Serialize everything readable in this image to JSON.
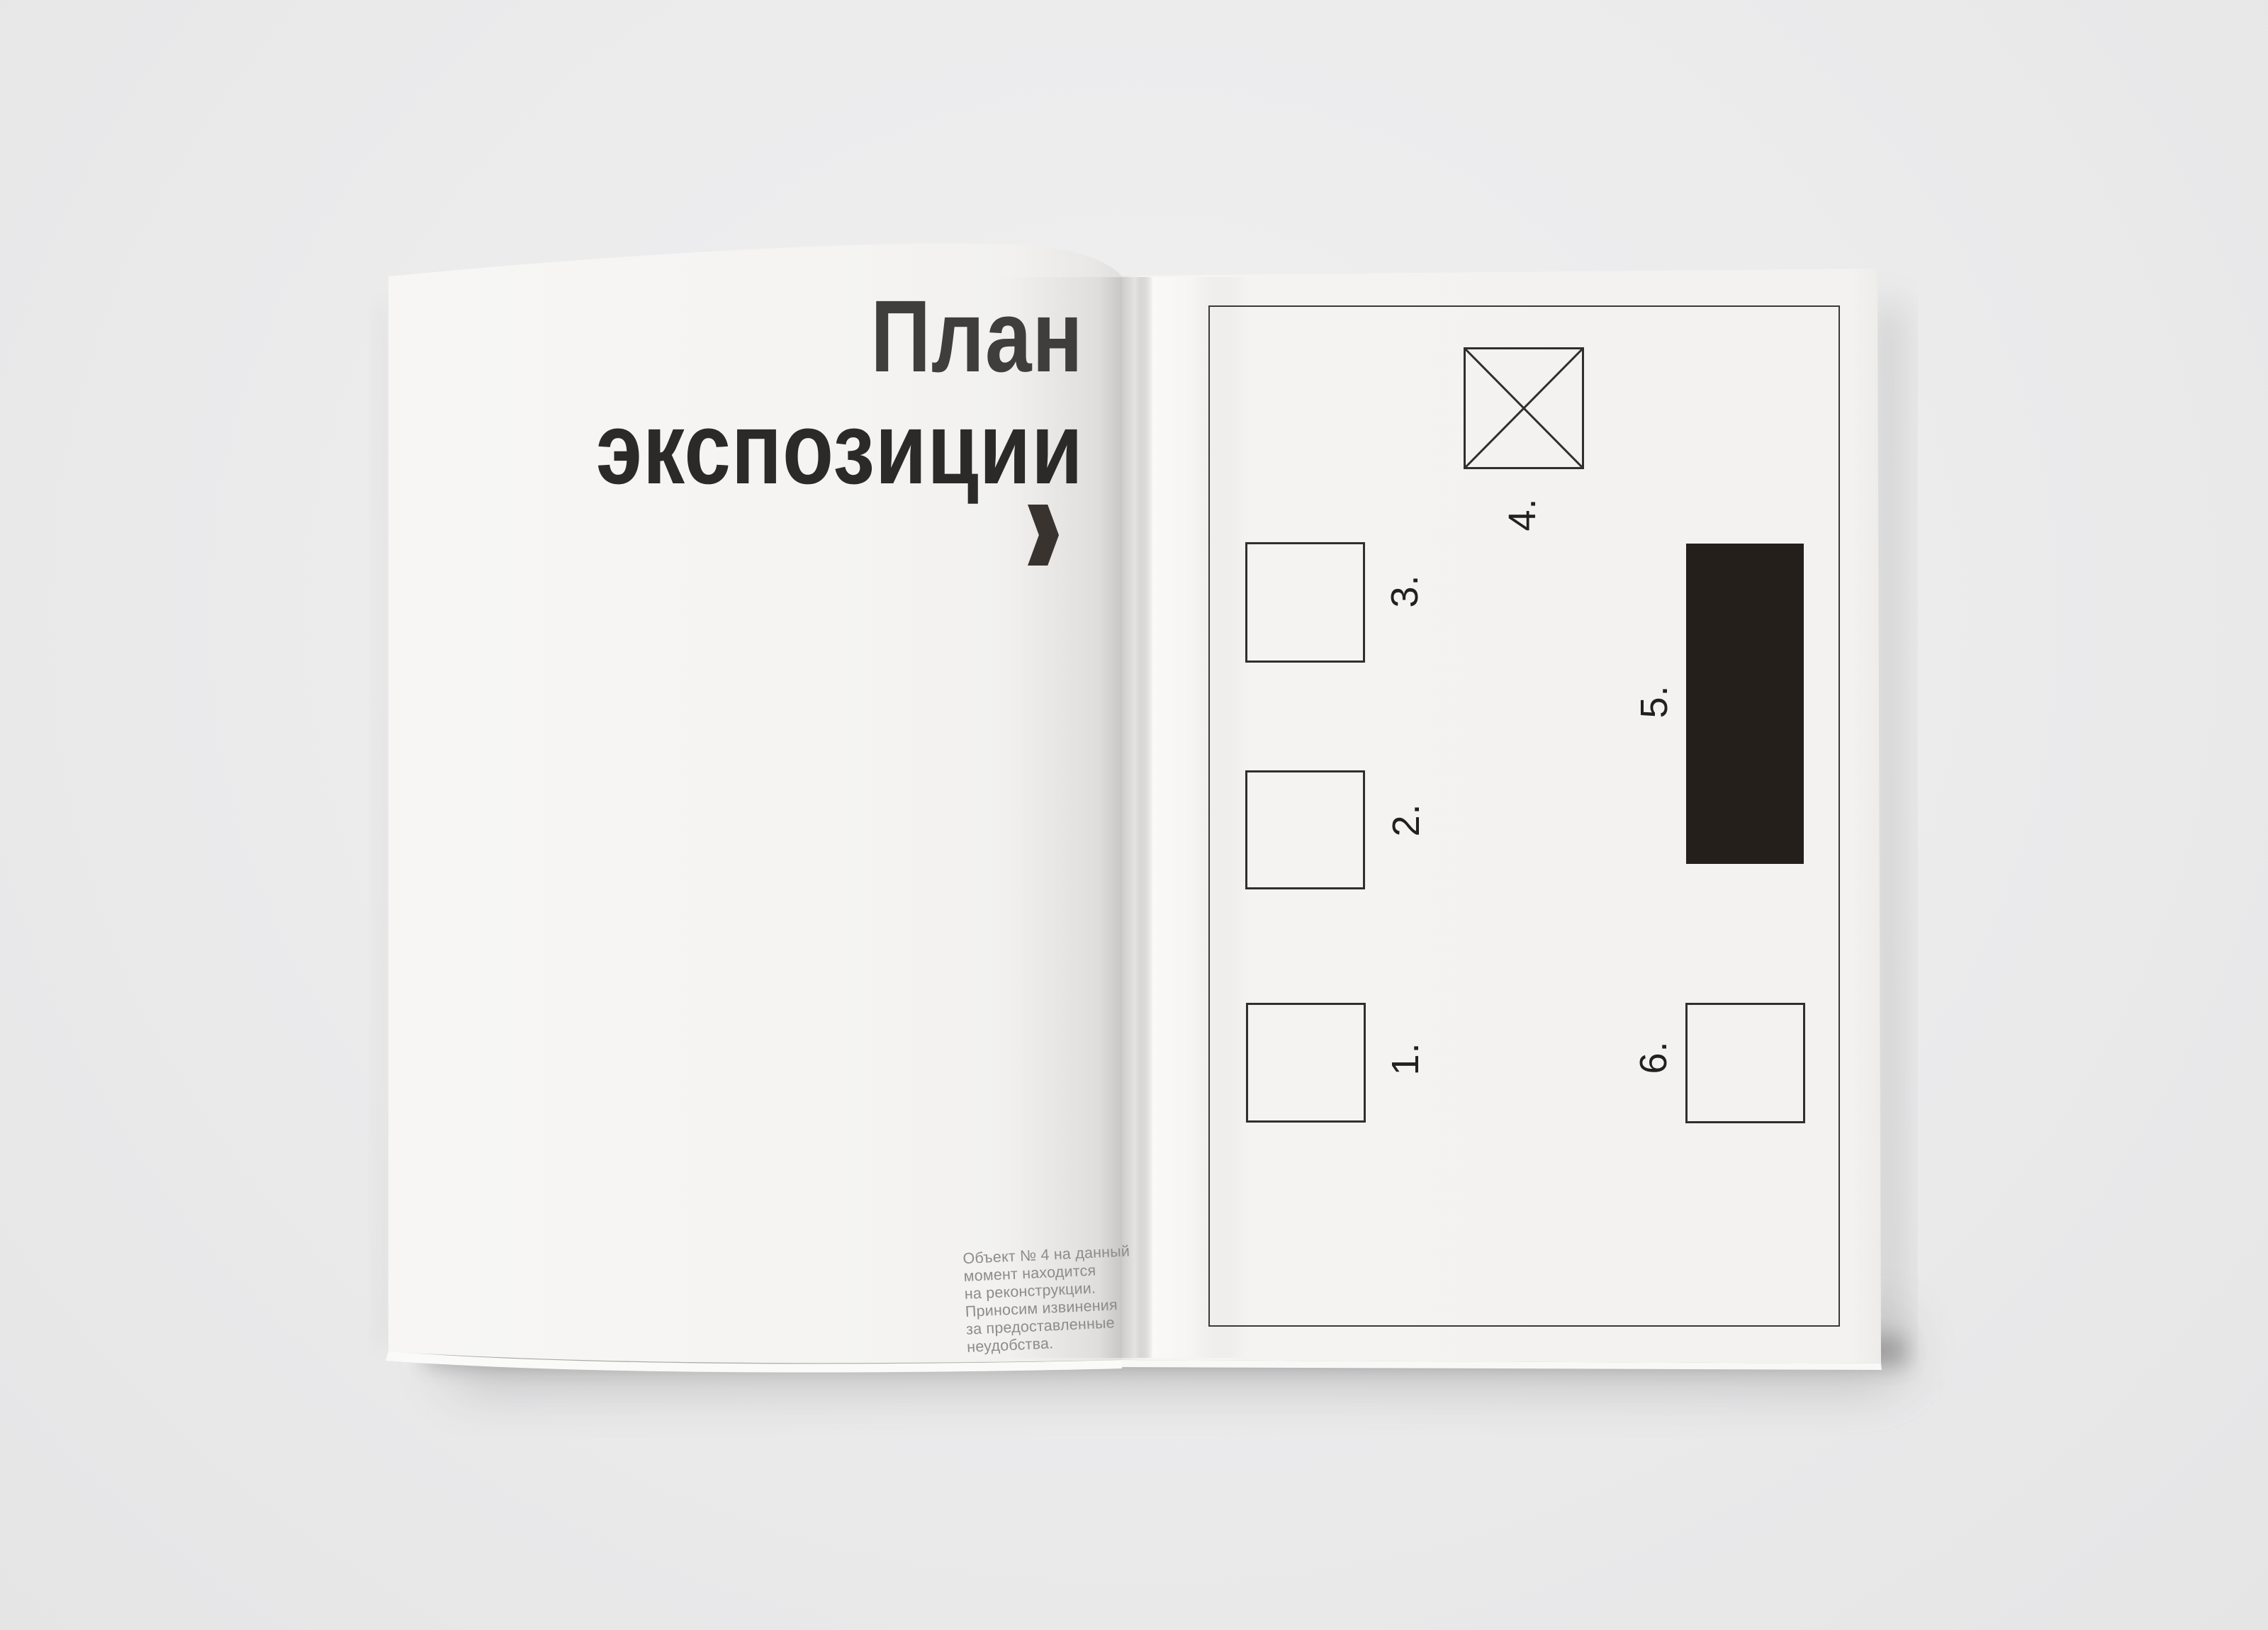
{
  "background": {
    "color": "#ebebec"
  },
  "left_page": {
    "title_line1": "План",
    "title_line2": "экспозиции",
    "arrow_icon": "chevron-right",
    "note": "Объект № 4 на данный\nмомент находится\nна реконструкции.\nПриносим извинения\nза предоставленные\nнеудобства."
  },
  "right_page": {
    "plan": {
      "rooms": [
        {
          "label": "1.",
          "shape": "outlined-square"
        },
        {
          "label": "2.",
          "shape": "outlined-square"
        },
        {
          "label": "3.",
          "shape": "outlined-square"
        },
        {
          "label": "4.",
          "shape": "crossed-square"
        },
        {
          "label": "5.",
          "shape": "filled-black-rectangle"
        },
        {
          "label": "6.",
          "shape": "outlined-square"
        }
      ]
    }
  },
  "colors": {
    "paper_right": "#f4f3f1",
    "paper_left": "#f6f5f3",
    "background": "#ebebec",
    "title_ink": "#343231",
    "plan_line": "#312f2d",
    "filled_block": "#241f1b",
    "note_text": "#8d8c8a"
  }
}
